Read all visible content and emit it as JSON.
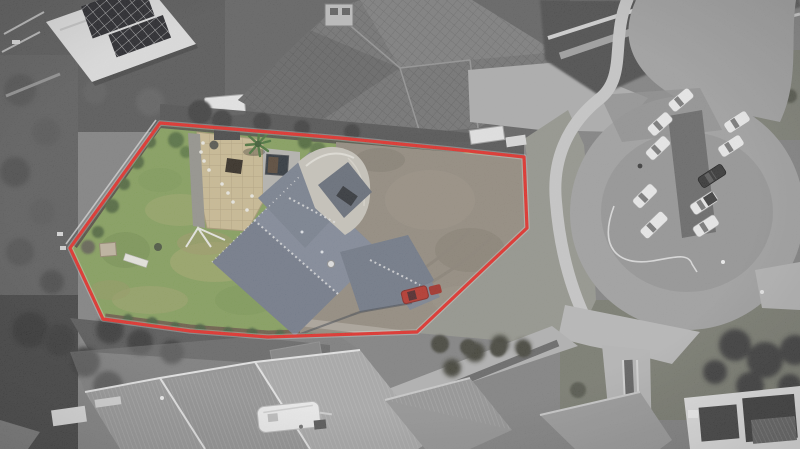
{
  "scene": {
    "type": "aerial-property-photo",
    "description": "Overhead drone photograph of a residential section outlined in red; the property inside the boundary is in colour (green lawn, slate roof, tan patio, gravel drive) while the surrounding streetscape is desaturated grey. A cul-de-sac head with ten parked vehicles sits to the right.",
    "highlight": {
      "label": "property-boundary",
      "color": "#e2201a",
      "casing_color": "#ffffff"
    },
    "counts": {
      "culdesac_vehicles": 10,
      "vehicles_on_property": 1,
      "caravans": 1
    },
    "palette": {
      "base_grey": "#7b7b7b",
      "ground_dark": "#474747",
      "scrub_dark": "#3a3a3a",
      "trees_dark": "#2f2f2f",
      "grass_muted": "#75776c",
      "asphalt": "#9c9c9c",
      "asphalt_worn": "#8f8f8f",
      "median_dark": "#5f5f5f",
      "sidewalk": "#c6c6c6",
      "concrete": "#b6b6b6",
      "neighbor_roof": "#929292",
      "neighbor_roof_dark": "#6a6a6a",
      "shed_white": "#dedede",
      "solar_panel": "#15151a",
      "lawn_green": "#7e9a52",
      "lawn_patch": "#a2a566",
      "patio_tan": "#c9b88d",
      "spa_deck": "#b2b0ab",
      "spa_dark": "#1f262e",
      "gravel": "#8d8477",
      "roof_slate": "#6a7282",
      "roof_slate_light": "#7a8292",
      "garage_cream": "#c6c2b8",
      "shrub_green": "#55703a",
      "shrub_orange": "#c09a40",
      "car_white": "#ececec",
      "car_black": "#262626",
      "car_red": "#b2271d",
      "caravan_white": "#efefef",
      "modern_house_wall": "#e6e6e6",
      "modern_house_roof": "#333333"
    }
  }
}
